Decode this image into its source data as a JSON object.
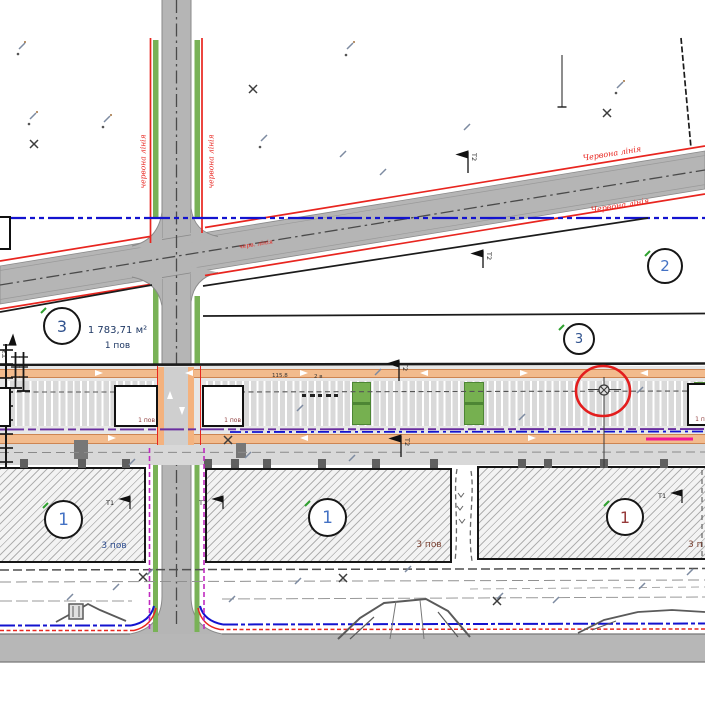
{
  "drawing_type": "site-plan",
  "colors": {
    "road": "#b5b5b5",
    "red_line": "#e8251f",
    "blue_utility": "#1313cf",
    "purple_utility": "#6a2fa0",
    "magenta_utility": "#c02ac0",
    "pink_marker": "#f01895",
    "green_strip": "#79b257",
    "orange_band": "#f2bb8d",
    "numeral_blue": "#4472c4",
    "numeral_red": "#963a3a",
    "label_navy": "#1f3864"
  },
  "zones": {
    "circle_2": "2",
    "circle_3_left": "3",
    "circle_3_right": "3",
    "circle_1_left": "1",
    "circle_1_mid": "1",
    "circle_1_right": "1"
  },
  "labels": {
    "area": "1 783,71 м²",
    "area_floors": "1 пов",
    "pavilion_floors": "1 пов",
    "building_floors_left": "3 пов",
    "building_floors_mid": "3 пов",
    "building_floors_right": "3 п",
    "red_line_vertical": "червона лінія",
    "red_line_diagonal": "Червона лінія",
    "red_line_small": "черв. лінія",
    "dim_width": "115.8",
    "dim_note": "2 в",
    "marker_t1": "Т1",
    "marker_t2": "Т2",
    "marker_t3": "Т3"
  }
}
